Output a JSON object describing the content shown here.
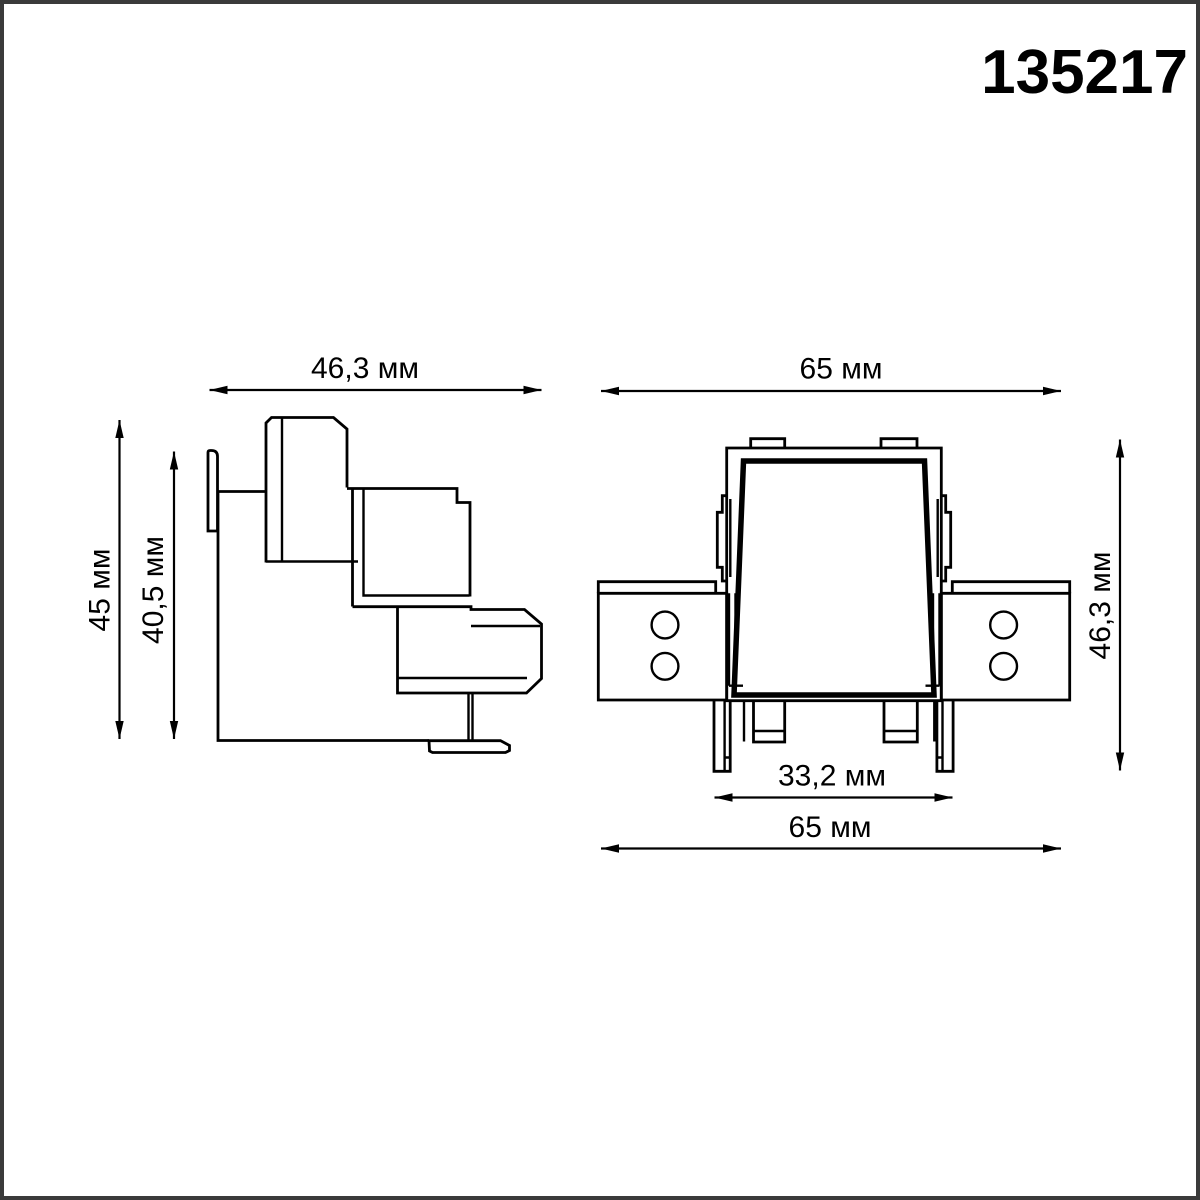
{
  "page": {
    "part_number": "135217",
    "background": "#ffffff",
    "border_color": "#3a3a3a",
    "ink_color": "#000000",
    "unit": "мм"
  },
  "side_view": {
    "name": "connector-side-view",
    "dim_width_top": "46,3 мм",
    "dim_height_outer": "45 мм",
    "dim_height_inner": "40,5 мм"
  },
  "front_view": {
    "name": "connector-front-view",
    "dim_width_top": "65 мм",
    "dim_height_right": "46,3 мм",
    "dim_width_feet": "33,2 мм",
    "dim_width_bottom": "65 мм",
    "hole_count": 4
  }
}
